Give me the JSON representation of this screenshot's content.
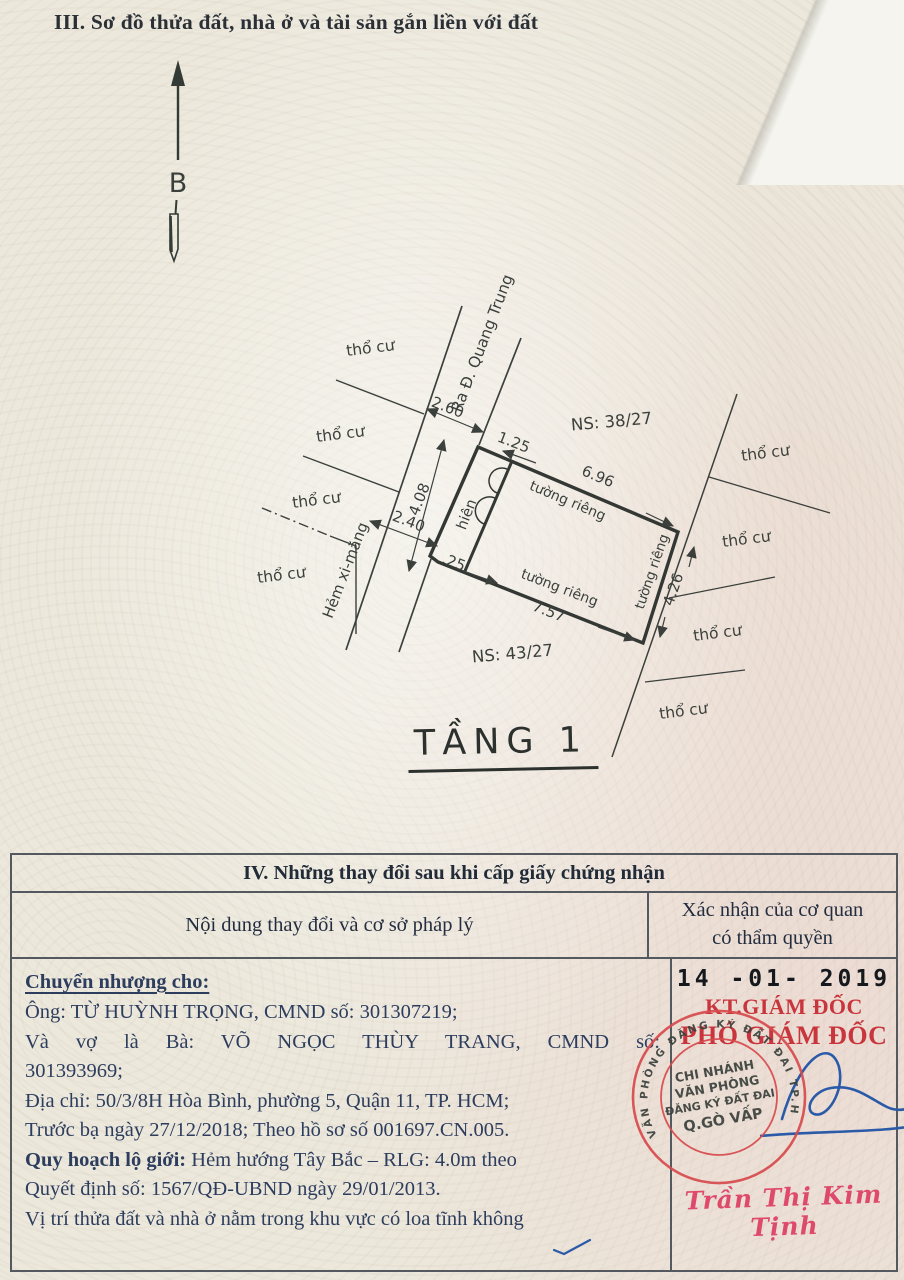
{
  "section3": {
    "title": "III. Sơ đồ thửa đất, nhà ở và tài sản gắn liền với đất",
    "north_label": "B",
    "floor_label": "TẦNG 1",
    "diagram": {
      "street_label": "Ra Đ. Quang Trung",
      "alley_label": "Hẻm xi-măng",
      "porch_label": "hiên",
      "neighbor_label": "thổ cư",
      "private_wall_label": "tường riêng",
      "ns_top": "NS: 38/27",
      "ns_bottom": "NS: 43/27",
      "dim_top": "6.96",
      "dim_bottom": "7.57",
      "dim_right": "4.26",
      "dim_front": "4.08",
      "dim_jog_top": "1.25",
      "dim_jog_bottom": ".25",
      "dim_alley_top": "2.60",
      "dim_alley_bottom": "2.40"
    }
  },
  "section4": {
    "title": "IV. Những thay đổi sau khi cấp giấy chứng nhận",
    "col1_header": "Nội dung thay đổi và cơ sở pháp lý",
    "col2_header_line1": "Xác nhận của cơ quan",
    "col2_header_line2": "có thẩm quyền",
    "content": {
      "heading": "Chuyển nhượng cho:",
      "lines": [
        {
          "t": "Ông: TỪ HUỲNH TRỌNG, CMND số: 301307219;"
        },
        {
          "t": "Và vợ là Bà: VÕ NGỌC THÙY TRANG, CMND số:",
          "cls": "j"
        },
        {
          "t": "301393969;"
        },
        {
          "t": "Địa chỉ: 50/3/8H Hòa Bình, phường 5, Quận 11, TP. HCM;"
        },
        {
          "t": "Trước bạ ngày 27/12/2018; Theo hồ sơ số 001697.CN.005."
        },
        {
          "b": "Quy hoạch lộ giới:",
          "t": " Hẻm hướng Tây Bắc – RLG: 4.0m theo"
        },
        {
          "t": "Quyết định số: 1567/QĐ-UBND ngày 29/01/2013."
        },
        {
          "t": "Vị trí thửa đất và nhà ở nằm trong khu vực có loa tĩnh không"
        }
      ]
    },
    "confirmation": {
      "date_stamp": "14 -01- 2019",
      "kt_line": "KT.GIÁM ĐỐC",
      "deputy_line": "PHÓ GIÁM ĐỐC",
      "stamp_ring_text": "VĂN PHÒNG ĐĂNG KÝ ĐẤT ĐAI TP.HỒ CHÍ MINH",
      "stamp_lines": [
        "CHI NHÁNH",
        "VĂN PHÒNG",
        "ĐĂNG KÝ ĐẤT ĐAI",
        "Q.GÒ VẤP"
      ],
      "signer_name": "Trần Thị Kim Tịnh"
    }
  },
  "colors": {
    "stamp_red": "#d84b4e",
    "text_red": "#c9353c",
    "signature_blue": "#2a5aa8",
    "name_red": "#de4a6a",
    "line": "#3c403d"
  }
}
